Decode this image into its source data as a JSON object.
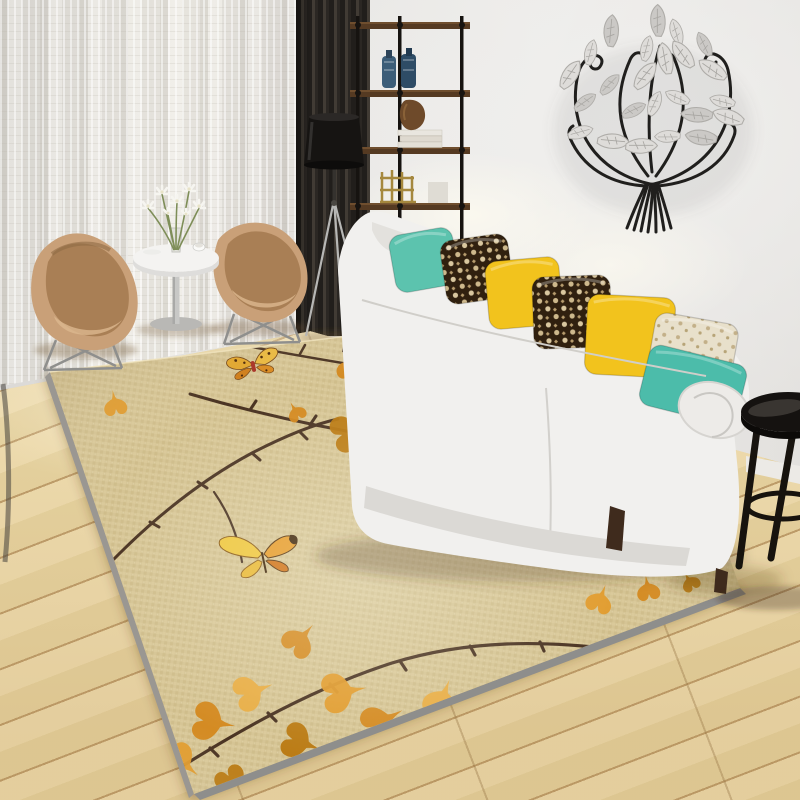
{
  "labels": {
    "scene": "Modern living room with autumn ginkgo branch area rug",
    "rug": "Beige woven rug with brown thorny branches, orange ginkgo leaves and two butterflies",
    "wall_art": "Black iron tree wall sculpture with silver metal leaves",
    "sofa": "White fabric three-seat sofa with accent pillows"
  },
  "palette": {
    "wall": "#e7e5e2",
    "curtain": "#eceae5",
    "slat_panel": "#2b2723",
    "floor_wood": "#e7d4a6",
    "floor_plank_line": "#bd9c6a",
    "baseboard": "#eceae6"
  },
  "wall_art": {
    "frame_color": "#201f1d",
    "leaf_color": "#dedcd9",
    "leaf_color_alt": "#cbc9c6"
  },
  "shelf": {
    "wood_color": "#553a22",
    "pipe_color": "#161310",
    "items": [
      "blue bottles",
      "white books",
      "brown vase",
      "brass ornament",
      "white box"
    ]
  },
  "floor_lamp": {
    "shade_color": "#161412",
    "leg_color": "#b7b7b5"
  },
  "chairs": {
    "color": "#c9a078",
    "inner_color": "#a97f55",
    "count": 2
  },
  "coffee_table": {
    "top_color": "#f4f3f1",
    "flower_color": "#f6f5f0",
    "stem_color": "#7e8e58"
  },
  "sofa": {
    "body_color": "#f1f0ee",
    "shade_color": "#dbd9d5",
    "leg_color": "#46311f",
    "pillow_colors": {
      "teal": "#5cc3ae",
      "teal2": "#4cbcaa",
      "yellow": "#f2c31d",
      "damask_base": "#30200f",
      "damask_motif": "#d9c79f",
      "cream_base": "#e8e0cb",
      "cream_motif": "#b7a477"
    },
    "pillows": [
      {
        "cx": 424,
        "cy": 260,
        "w": 64,
        "h": 58,
        "rot": -10,
        "kind": "teal"
      },
      {
        "cx": 477,
        "cy": 269,
        "w": 68,
        "h": 64,
        "rot": -8,
        "kind": "damask"
      },
      {
        "cx": 524,
        "cy": 293,
        "w": 74,
        "h": 68,
        "rot": -5,
        "kind": "yellow"
      },
      {
        "cx": 572,
        "cy": 312,
        "w": 78,
        "h": 72,
        "rot": -2,
        "kind": "damask"
      },
      {
        "cx": 630,
        "cy": 336,
        "w": 88,
        "h": 80,
        "rot": 3,
        "kind": "yellow"
      },
      {
        "cx": 693,
        "cy": 350,
        "w": 84,
        "h": 64,
        "rot": 10,
        "kind": "cream"
      },
      {
        "cx": 693,
        "cy": 385,
        "w": 100,
        "h": 62,
        "rot": 14,
        "kind": "teal2"
      }
    ]
  },
  "side_table": {
    "color": "#151210",
    "leg_color": "#17130e"
  },
  "rug": {
    "polygon": "50,372 640,301 740,588 194,794",
    "base_color": "#d5c494",
    "edge_color": "#8e8e8c",
    "edge_left_color": "#9a9792",
    "branch_color": "#4a3322",
    "leaf_palette": [
      "#d4881c",
      "#e29b2b",
      "#b9780f",
      "#e9ad42",
      "#c98a24"
    ],
    "butterfly_count": 2,
    "branches": [
      [
        "M252,347 C330,362 430,377 512,391 M300,354 l5,-9 M360,362 l5,-9 M420,371 l5,-9 M470,379 l4,-8",
        2.5
      ],
      [
        "M190,394 C265,416 345,433 433,445 C505,454 575,468 642,484 M250,410 l6,-9 M310,425 l6,-9 M380,438 l5,-9 M455,449 l5,-8 M530,461 l5,-8 M595,474 l5,-8",
        3
      ],
      [
        "M110,563 C150,522 198,482 252,453 C285,436 315,424 338,419 M150,522 l9,5 M198,482 l9,6 M252,453 l8,7 M300,432 l7,7",
        3
      ],
      [
        "M214,492 C228,512 238,536 242,562",
        2.2
      ],
      [
        "M140,793 C225,738 305,691 392,663 C470,639 545,641 612,649 M210,748 l8,8 M268,713 l8,8 M330,684 l7,8 M400,661 l6,9 M470,646 l5,9 M540,642 l4,9",
        3.2
      ],
      [
        "M552,689 C598,664 650,642 706,612 M585,671 l6,8 M630,650 l6,8 M672,629 l6,8",
        2.6
      ],
      [
        "M604,757 C645,719 685,688 724,656 M638,726 l8,6 M676,695 l8,6",
        2.4
      ],
      [
        "M652,523 C684,483 716,456 752,432 M680,497 l8,6 M712,470 l8,6",
        2.4
      ],
      [
        "M660,470 C712,450 762,431 800,419 M700,455 l6,8 M745,438 l6,8",
        2.2
      ],
      [
        "M545,336 C600,343 655,351 700,359 M590,342 l4,-8 M640,349 l4,-8",
        2.2
      ]
    ],
    "leaves": [
      [
        352,
        368,
        0.9,
        200,
        0
      ],
      [
        380,
        344,
        0.75,
        160,
        1
      ],
      [
        350,
        432,
        1.2,
        250,
        2
      ],
      [
        398,
        458,
        1.3,
        210,
        0
      ],
      [
        432,
        420,
        1.1,
        150,
        1
      ],
      [
        458,
        390,
        0.9,
        120,
        3
      ],
      [
        422,
        366,
        0.7,
        90,
        2
      ],
      [
        472,
        447,
        1.35,
        190,
        0
      ],
      [
        502,
        482,
        1.2,
        230,
        1
      ],
      [
        442,
        502,
        1.05,
        270,
        2
      ],
      [
        396,
        522,
        0.9,
        300,
        3
      ],
      [
        520,
        432,
        0.8,
        140,
        1
      ],
      [
        506,
        402,
        0.65,
        100,
        0
      ],
      [
        590,
        432,
        0.9,
        150,
        1
      ],
      [
        622,
        470,
        1.15,
        200,
        0
      ],
      [
        660,
        500,
        1.3,
        240,
        2
      ],
      [
        700,
        470,
        1.05,
        170,
        1
      ],
      [
        682,
        430,
        0.8,
        120,
        0
      ],
      [
        718,
        520,
        1.15,
        260,
        3
      ],
      [
        652,
        545,
        1.0,
        290,
        1
      ],
      [
        744,
        452,
        0.75,
        140,
        2
      ],
      [
        756,
        500,
        0.85,
        220,
        0
      ],
      [
        612,
        520,
        0.85,
        310,
        3
      ],
      [
        600,
        600,
        0.85,
        200,
        1
      ],
      [
        648,
        589,
        0.75,
        170,
        0
      ],
      [
        690,
        582,
        0.6,
        150,
        2
      ],
      [
        300,
        640,
        1.05,
        220,
        0
      ],
      [
        342,
        692,
        1.3,
        260,
        1
      ],
      [
        300,
        742,
        1.15,
        290,
        2
      ],
      [
        382,
        722,
        1.25,
        240,
        0
      ],
      [
        442,
        700,
        1.15,
        200,
        3
      ],
      [
        422,
        762,
        1.3,
        270,
        1
      ],
      [
        500,
        722,
        1.0,
        230,
        0
      ],
      [
        542,
        690,
        0.85,
        190,
        2
      ],
      [
        562,
        742,
        1.15,
        260,
        1
      ],
      [
        622,
        700,
        0.95,
        220,
        0
      ],
      [
        662,
        660,
        0.85,
        180,
        3
      ],
      [
        702,
        640,
        0.7,
        150,
        1
      ],
      [
        482,
        782,
        1.1,
        300,
        2
      ],
      [
        252,
        692,
        1.15,
        250,
        3
      ],
      [
        212,
        722,
        1.25,
        280,
        0
      ],
      [
        182,
        762,
        1.1,
        310,
        1
      ],
      [
        232,
        782,
        1.0,
        330,
        2
      ],
      [
        115,
        404,
        0.75,
        170,
        1
      ],
      [
        296,
        412,
        0.6,
        150,
        0
      ]
    ]
  }
}
